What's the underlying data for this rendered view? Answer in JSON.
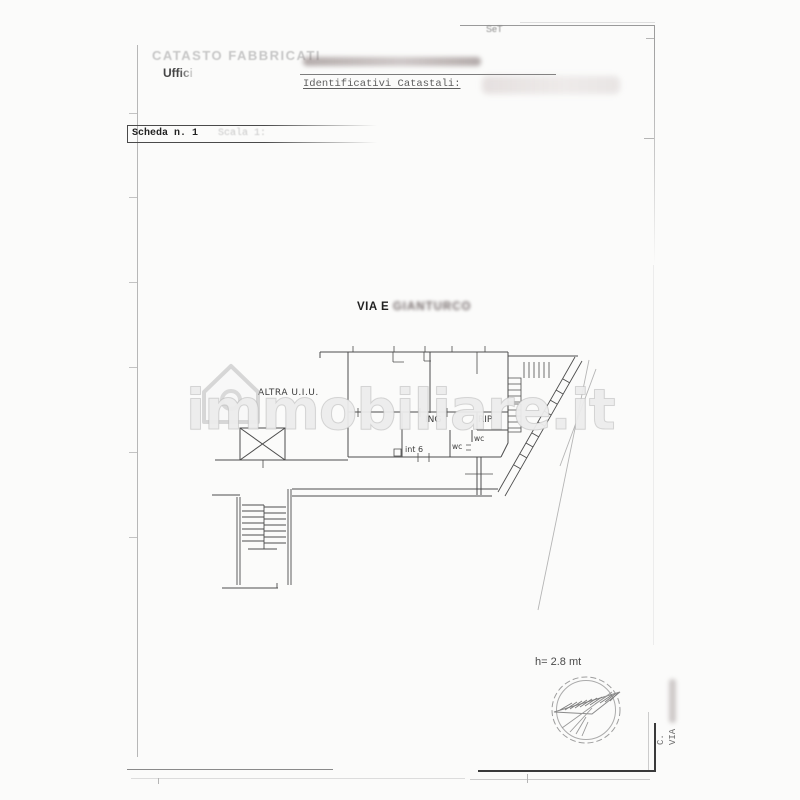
{
  "page": {
    "corner_note": "SeT",
    "header": {
      "registry_title": "CATASTO FABBRICATI",
      "office_label": "Uffici",
      "identifiers_label": "Identificativi Catastali:"
    },
    "scheda": {
      "label": "Scheda n. 1",
      "scale_label": "Scala 1:"
    },
    "street": {
      "prefix": "VIA E",
      "redacted_name": "GIANTURCO"
    },
    "plan_labels": {
      "other_unit": "ALTRA U.I.U.",
      "entrance": "ING",
      "storage": "RIP",
      "wc_left": "wc",
      "wc_right": "wc",
      "unit_number": "int 6"
    },
    "annotations": {
      "ceiling_height": "h= 2.8 mt"
    },
    "side_text": {
      "line1": "C.",
      "line2": "VIA"
    },
    "watermark": {
      "text": "immobiliare.it"
    },
    "colors": {
      "plan_line": "#4d4d4d",
      "faint_line": "#b5b5b5",
      "watermark_gray": "#bdbdbd",
      "redaction_tint": "#8d7d7d"
    }
  }
}
